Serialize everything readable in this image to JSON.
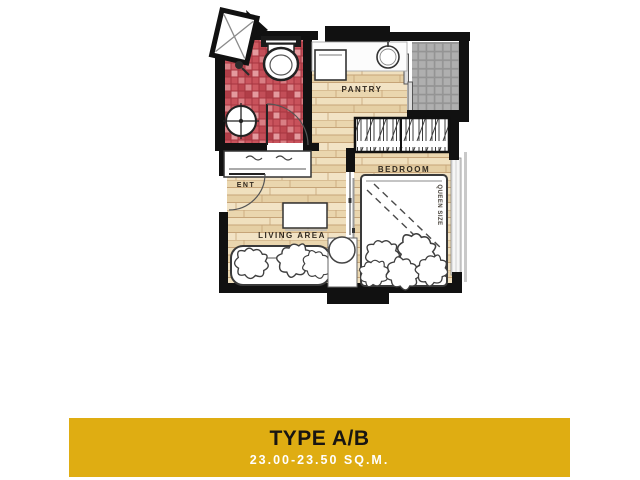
{
  "plan": {
    "labels": {
      "ent": "ENT",
      "living_area": "LIVING AREA",
      "bedroom": "BEDROOM",
      "pantry": "PANTRY",
      "queen_size": "QUEEN SIZE"
    },
    "colors": {
      "wall": "#111111",
      "wood_floor": "#EBD9B3",
      "wood_plank_line": "#C6A478",
      "bathroom_tile_red": "#C9545C",
      "balcony_tile_gray": "#B4B4B4",
      "label_text": "#31291f"
    }
  },
  "banner": {
    "title": "TYPE A/B",
    "subtitle": "23.00-23.50 SQ.M.",
    "background": "#DFAD12",
    "title_color": "#181512",
    "subtitle_color": "#ffffff"
  }
}
